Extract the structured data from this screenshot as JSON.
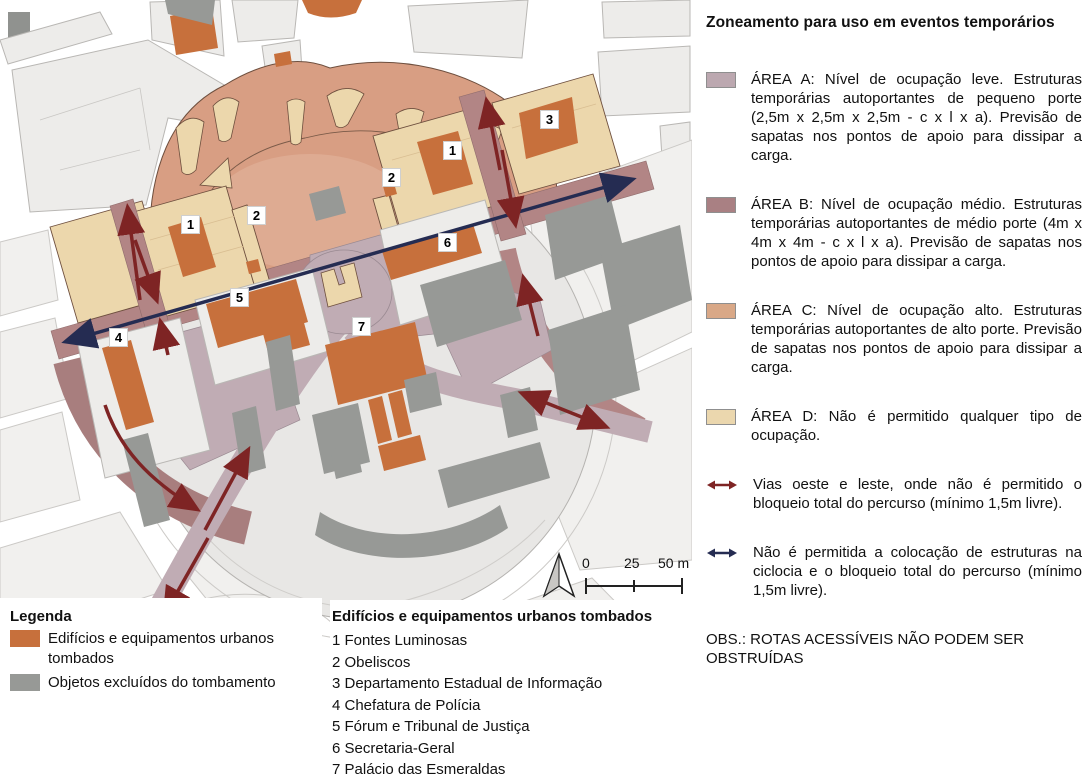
{
  "panel": {
    "title": "Zoneamento para uso em eventos temporários",
    "zones": [
      {
        "name": "ÁREA A",
        "color": "#BCA8B0",
        "text": "ÁREA A: Nível de ocupação leve. Estruturas temporárias autoportantes de pequeno porte (2,5m x 2,5m x 2,5m - c x l x a). Previsão de sapatas nos pontos de apoio para dissipar a carga."
      },
      {
        "name": "ÁREA B",
        "color": "#A98083",
        "text": "ÁREA B: Nível de ocupação médio. Estruturas temporárias autoportantes de médio porte (4m x 4m x 4m - c x l x a). Previsão de sapatas nos pontos de apoio para dissipar a carga."
      },
      {
        "name": "ÁREA C",
        "color": "#D9A887",
        "text": "ÁREA C: Nível de ocupação alto. Estruturas temporárias autoportantes de alto porte. Previsão de sapatas nos pontos de apoio para dissipar a carga."
      },
      {
        "name": "ÁREA D",
        "color": "#EBD7AE",
        "text": "ÁREA D: Não é permitido qualquer tipo de ocupação."
      }
    ],
    "route_notes": [
      {
        "arrow_color": "#7E2424",
        "text": "Vias oeste e leste, onde não é permitido o bloqueio total do percurso (mínimo 1,5m livre)."
      },
      {
        "arrow_color": "#252C52",
        "text": "Não é permitida a colocação de estruturas na ciclocia e o bloqueio total do percurso (mínimo 1,5m livre)."
      }
    ],
    "obs": "OBS.: ROTAS ACESSÍVEIS NÃO PODEM SER OBSTRUÍDAS"
  },
  "legend": {
    "title": "Legenda",
    "items": [
      {
        "color": "#C7703C",
        "text": "Edifícios e equipamentos urbanos tombados"
      },
      {
        "color": "#979996",
        "text": "Objetos excluídos do tombamento"
      }
    ]
  },
  "listed_buildings": {
    "title": "Edifícios e equipamentos urbanos tombados",
    "items": [
      "1 Fontes Luminosas",
      "2 Obeliscos",
      "3 Departamento Estadual de Informação",
      "4 Chefatura de Polícia",
      "5 Fórum e Tribunal de Justiça",
      "6 Secretaria-Geral",
      "7 Palácio das Esmeraldas"
    ]
  },
  "map_markers": [
    "1",
    "2",
    "2",
    "1",
    "3",
    "4",
    "5",
    "6",
    "7"
  ],
  "scale_bar": {
    "labels": [
      "0",
      "25",
      "50 m"
    ]
  },
  "map_colors": {
    "area_a_mauve": "#C0ACB4",
    "area_b_rosy": "#B28585",
    "area_c_salmon": "#D89E83",
    "area_d_cream": "#ECD7AC",
    "listed_orange": "#C7703C",
    "excluded_gray": "#979996",
    "route_red": "#7E2424",
    "axis_navy": "#252C52"
  }
}
